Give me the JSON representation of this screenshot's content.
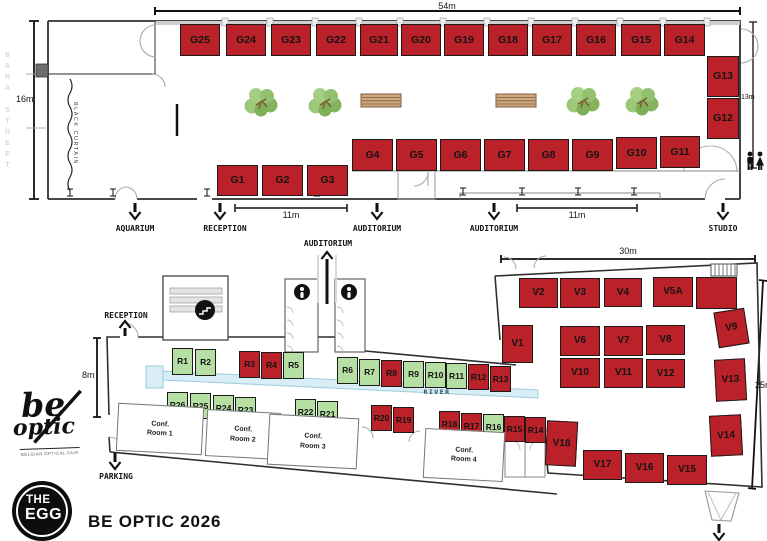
{
  "title": "BE OPTIC 2026",
  "logo": {
    "script_top": "be",
    "script_bottom": "optic",
    "tagline": "BELGIAN OPTICAL FAIR",
    "egg_line1": "THE",
    "egg_line2": "EGG"
  },
  "colors": {
    "red": "#bb2129",
    "green": "#b6dfa4",
    "river": "#d8edf5",
    "river_stroke": "#9cccdd",
    "wall": "#2f2f2f"
  },
  "upper_booths": [
    {
      "id": "G25",
      "x": 180,
      "y": 24,
      "w": 40,
      "h": 32,
      "c": "red"
    },
    {
      "id": "G24",
      "x": 226,
      "y": 24,
      "w": 40,
      "h": 32,
      "c": "red"
    },
    {
      "id": "G23",
      "x": 271,
      "y": 24,
      "w": 40,
      "h": 32,
      "c": "red"
    },
    {
      "id": "G22",
      "x": 316,
      "y": 24,
      "w": 40,
      "h": 32,
      "c": "red"
    },
    {
      "id": "G21",
      "x": 360,
      "y": 24,
      "w": 38,
      "h": 32,
      "c": "red"
    },
    {
      "id": "G20",
      "x": 401,
      "y": 24,
      "w": 40,
      "h": 32,
      "c": "red"
    },
    {
      "id": "G19",
      "x": 444,
      "y": 24,
      "w": 40,
      "h": 32,
      "c": "red"
    },
    {
      "id": "G18",
      "x": 488,
      "y": 24,
      "w": 40,
      "h": 32,
      "c": "red"
    },
    {
      "id": "G17",
      "x": 532,
      "y": 24,
      "w": 40,
      "h": 32,
      "c": "red"
    },
    {
      "id": "G16",
      "x": 576,
      "y": 24,
      "w": 40,
      "h": 32,
      "c": "red"
    },
    {
      "id": "G15",
      "x": 621,
      "y": 24,
      "w": 40,
      "h": 32,
      "c": "red"
    },
    {
      "id": "G14",
      "x": 664,
      "y": 24,
      "w": 41,
      "h": 32,
      "c": "red"
    },
    {
      "id": "G13",
      "x": 707,
      "y": 56,
      "w": 32,
      "h": 41,
      "c": "red"
    },
    {
      "id": "G12",
      "x": 707,
      "y": 98,
      "w": 32,
      "h": 41,
      "c": "red"
    },
    {
      "id": "G4",
      "x": 352,
      "y": 139,
      "w": 41,
      "h": 32,
      "c": "red"
    },
    {
      "id": "G5",
      "x": 396,
      "y": 139,
      "w": 41,
      "h": 32,
      "c": "red"
    },
    {
      "id": "G6",
      "x": 440,
      "y": 139,
      "w": 41,
      "h": 32,
      "c": "red"
    },
    {
      "id": "G7",
      "x": 484,
      "y": 139,
      "w": 41,
      "h": 32,
      "c": "red"
    },
    {
      "id": "G8",
      "x": 528,
      "y": 139,
      "w": 41,
      "h": 32,
      "c": "red"
    },
    {
      "id": "G9",
      "x": 572,
      "y": 139,
      "w": 41,
      "h": 32,
      "c": "red"
    },
    {
      "id": "G10",
      "x": 616,
      "y": 137,
      "w": 41,
      "h": 32,
      "c": "red"
    },
    {
      "id": "G11",
      "x": 660,
      "y": 136,
      "w": 40,
      "h": 32,
      "c": "red"
    },
    {
      "id": "G1",
      "x": 217,
      "y": 165,
      "w": 41,
      "h": 31,
      "c": "red"
    },
    {
      "id": "G2",
      "x": 262,
      "y": 165,
      "w": 41,
      "h": 31,
      "c": "red"
    },
    {
      "id": "G3",
      "x": 307,
      "y": 165,
      "w": 41,
      "h": 31,
      "c": "red"
    }
  ],
  "r_booths": [
    {
      "id": "R1",
      "x": 172,
      "y": 348,
      "w": 21,
      "h": 27,
      "c": "green"
    },
    {
      "id": "R2",
      "x": 195,
      "y": 349,
      "w": 21,
      "h": 27,
      "c": "green"
    },
    {
      "id": "R3",
      "x": 239,
      "y": 351,
      "w": 21,
      "h": 27,
      "c": "red"
    },
    {
      "id": "R4",
      "x": 261,
      "y": 352,
      "w": 21,
      "h": 27,
      "c": "red"
    },
    {
      "id": "R5",
      "x": 283,
      "y": 352,
      "w": 21,
      "h": 27,
      "c": "green"
    },
    {
      "id": "R6",
      "x": 337,
      "y": 357,
      "w": 21,
      "h": 27,
      "c": "green"
    },
    {
      "id": "R7",
      "x": 359,
      "y": 359,
      "w": 21,
      "h": 27,
      "c": "green"
    },
    {
      "id": "R8",
      "x": 381,
      "y": 360,
      "w": 21,
      "h": 27,
      "c": "red"
    },
    {
      "id": "R9",
      "x": 403,
      "y": 361,
      "w": 21,
      "h": 27,
      "c": "green"
    },
    {
      "id": "R10",
      "x": 425,
      "y": 362,
      "w": 21,
      "h": 26,
      "c": "green"
    },
    {
      "id": "R11",
      "x": 446,
      "y": 363,
      "w": 21,
      "h": 26,
      "c": "green"
    },
    {
      "id": "R12",
      "x": 468,
      "y": 364,
      "w": 21,
      "h": 26,
      "c": "red"
    },
    {
      "id": "R13",
      "x": 490,
      "y": 366,
      "w": 21,
      "h": 26,
      "c": "red"
    },
    {
      "id": "R26",
      "x": 167,
      "y": 392,
      "w": 21,
      "h": 26,
      "c": "green"
    },
    {
      "id": "R25",
      "x": 190,
      "y": 393,
      "w": 21,
      "h": 26,
      "c": "green"
    },
    {
      "id": "R24",
      "x": 213,
      "y": 395,
      "w": 21,
      "h": 26,
      "c": "green"
    },
    {
      "id": "R23",
      "x": 235,
      "y": 397,
      "w": 21,
      "h": 26,
      "c": "green"
    },
    {
      "id": "R22",
      "x": 295,
      "y": 399,
      "w": 21,
      "h": 26,
      "c": "green"
    },
    {
      "id": "R21",
      "x": 317,
      "y": 401,
      "w": 21,
      "h": 26,
      "c": "green"
    },
    {
      "id": "R20",
      "x": 371,
      "y": 405,
      "w": 21,
      "h": 26,
      "c": "red"
    },
    {
      "id": "R19",
      "x": 393,
      "y": 407,
      "w": 21,
      "h": 26,
      "c": "red"
    },
    {
      "id": "R18",
      "x": 439,
      "y": 411,
      "w": 21,
      "h": 26,
      "c": "red"
    },
    {
      "id": "R17",
      "x": 461,
      "y": 413,
      "w": 21,
      "h": 26,
      "c": "red"
    },
    {
      "id": "R16",
      "x": 483,
      "y": 414,
      "w": 21,
      "h": 26,
      "c": "green"
    },
    {
      "id": "R15",
      "x": 504,
      "y": 416,
      "w": 21,
      "h": 26,
      "c": "red"
    },
    {
      "id": "R14",
      "x": 525,
      "y": 417,
      "w": 21,
      "h": 26,
      "c": "red"
    }
  ],
  "v_booths": [
    {
      "id": "V1",
      "x": 502,
      "y": 325,
      "w": 31,
      "h": 38,
      "c": "red"
    },
    {
      "id": "V2",
      "x": 519,
      "y": 278,
      "w": 39,
      "h": 30,
      "c": "red"
    },
    {
      "id": "V3",
      "x": 560,
      "y": 278,
      "w": 40,
      "h": 30,
      "c": "red"
    },
    {
      "id": "V4",
      "x": 604,
      "y": 278,
      "w": 38,
      "h": 29,
      "c": "red"
    },
    {
      "id": "V5A",
      "x": 653,
      "y": 277,
      "w": 40,
      "h": 30,
      "c": "red"
    },
    {
      "id": "",
      "x": 696,
      "y": 277,
      "w": 41,
      "h": 32,
      "c": "red"
    },
    {
      "id": "V6",
      "x": 560,
      "y": 326,
      "w": 40,
      "h": 30,
      "c": "red"
    },
    {
      "id": "V7",
      "x": 604,
      "y": 326,
      "w": 39,
      "h": 30,
      "c": "red"
    },
    {
      "id": "V8",
      "x": 646,
      "y": 325,
      "w": 39,
      "h": 30,
      "c": "red"
    },
    {
      "id": "V9",
      "x": 716,
      "y": 310,
      "w": 31,
      "h": 36,
      "c": "red",
      "rot": -9
    },
    {
      "id": "V10",
      "x": 560,
      "y": 358,
      "w": 40,
      "h": 30,
      "c": "red"
    },
    {
      "id": "V11",
      "x": 604,
      "y": 358,
      "w": 39,
      "h": 30,
      "c": "red"
    },
    {
      "id": "V12",
      "x": 646,
      "y": 359,
      "w": 39,
      "h": 29,
      "c": "red"
    },
    {
      "id": "V13",
      "x": 715,
      "y": 359,
      "w": 31,
      "h": 42,
      "c": "red",
      "rot": -3
    },
    {
      "id": "V14",
      "x": 710,
      "y": 415,
      "w": 32,
      "h": 41,
      "c": "red",
      "rot": -3
    },
    {
      "id": "V18",
      "x": 546,
      "y": 421,
      "w": 31,
      "h": 45,
      "c": "red",
      "rot": 3
    },
    {
      "id": "V17",
      "x": 583,
      "y": 450,
      "w": 39,
      "h": 30,
      "c": "red"
    },
    {
      "id": "V16",
      "x": 625,
      "y": 453,
      "w": 39,
      "h": 30,
      "c": "red"
    },
    {
      "id": "V15",
      "x": 667,
      "y": 455,
      "w": 40,
      "h": 30,
      "c": "red"
    }
  ],
  "conference_rooms": [
    {
      "line1": "Conf.",
      "line2": "Room 1",
      "x": 117,
      "y": 405,
      "w": 86,
      "h": 48,
      "rot": 3,
      "name": "conference-room-1"
    },
    {
      "line1": "Conf.",
      "line2": "Room 2",
      "x": 206,
      "y": 411,
      "w": 74,
      "h": 47,
      "rot": 3,
      "name": "conference-room-2"
    },
    {
      "line1": "Conf.",
      "line2": "Room 3",
      "x": 268,
      "y": 416,
      "w": 90,
      "h": 51,
      "rot": 3,
      "name": "conference-room-3"
    },
    {
      "line1": "Conf.",
      "line2": "Room 4",
      "x": 424,
      "y": 430,
      "w": 80,
      "h": 50,
      "rot": 3,
      "name": "conference-room-4"
    }
  ],
  "labels": [
    {
      "text": "54m",
      "x": 447,
      "y": 1,
      "cls": "dim",
      "name": "dim-54m"
    },
    {
      "text": "16m",
      "x": 16,
      "y": 94,
      "cls": "dim nc",
      "name": "dim-16m"
    },
    {
      "text": "13m",
      "x": 741,
      "y": 94,
      "cls": "dim sm nc",
      "name": "dim-13m"
    },
    {
      "text": "11m",
      "x": 291,
      "y": 210,
      "cls": "dim",
      "name": "dim-11m-left"
    },
    {
      "text": "11m",
      "x": 577,
      "y": 210,
      "cls": "dim",
      "name": "dim-11m-right"
    },
    {
      "text": "30m",
      "x": 628,
      "y": 246,
      "cls": "dim",
      "name": "dim-30m"
    },
    {
      "text": "25m",
      "x": 755,
      "y": 380,
      "cls": "dim nc",
      "name": "dim-25m"
    },
    {
      "text": "8m",
      "x": 82,
      "y": 370,
      "cls": "dim nc",
      "name": "dim-8m"
    },
    {
      "text": "AQUARIUM",
      "x": 135,
      "y": 224,
      "cls": "",
      "name": "exit-label-aquarium"
    },
    {
      "text": "RECEPTION",
      "x": 225,
      "y": 224,
      "cls": "",
      "name": "exit-label-reception-upper"
    },
    {
      "text": "AUDITORIUM",
      "x": 377,
      "y": 224,
      "cls": "",
      "name": "exit-label-auditorium-1"
    },
    {
      "text": "AUDITORIUM",
      "x": 494,
      "y": 224,
      "cls": "",
      "name": "exit-label-auditorium-2"
    },
    {
      "text": "STUDIO",
      "x": 723,
      "y": 224,
      "cls": "",
      "name": "exit-label-studio"
    },
    {
      "text": "AUDITORIUM",
      "x": 328,
      "y": 239,
      "cls": "",
      "name": "entrance-label-auditorium-lower"
    },
    {
      "text": "RECEPTION",
      "x": 126,
      "y": 311,
      "cls": "",
      "name": "entrance-label-reception-lower"
    },
    {
      "text": "PARKING",
      "x": 116,
      "y": 472,
      "cls": "",
      "name": "exit-label-parking"
    },
    {
      "text": "RIVER",
      "x": 437,
      "y": 388,
      "cls": "riv",
      "name": "river-label"
    },
    {
      "text": "BARA STREET",
      "x": 4,
      "y": 52,
      "cls": "street",
      "name": "street-label"
    },
    {
      "text": "BLACK CURTAIN",
      "x": 72,
      "y": 102,
      "cls": "curtain",
      "name": "curtain-label"
    }
  ],
  "arrows": [
    {
      "x": 135,
      "y": 203,
      "len": 16,
      "dir": "down",
      "name": "arrow-aquarium"
    },
    {
      "x": 220,
      "y": 203,
      "len": 16,
      "dir": "down",
      "name": "arrow-reception-upper"
    },
    {
      "x": 377,
      "y": 203,
      "len": 16,
      "dir": "down",
      "name": "arrow-auditorium-1"
    },
    {
      "x": 494,
      "y": 203,
      "len": 16,
      "dir": "down",
      "name": "arrow-auditorium-2"
    },
    {
      "x": 723,
      "y": 203,
      "len": 16,
      "dir": "down",
      "name": "arrow-studio"
    },
    {
      "x": 327,
      "y": 252,
      "len": 52,
      "dir": "up",
      "name": "arrow-auditorium-lower"
    },
    {
      "x": 125,
      "y": 321,
      "len": 15,
      "dir": "up",
      "name": "arrow-reception-lower"
    },
    {
      "x": 115,
      "y": 453,
      "len": 16,
      "dir": "down",
      "name": "arrow-parking"
    },
    {
      "x": 719,
      "y": 524,
      "len": 16,
      "dir": "down",
      "name": "arrow-exit-bottom-right"
    }
  ]
}
